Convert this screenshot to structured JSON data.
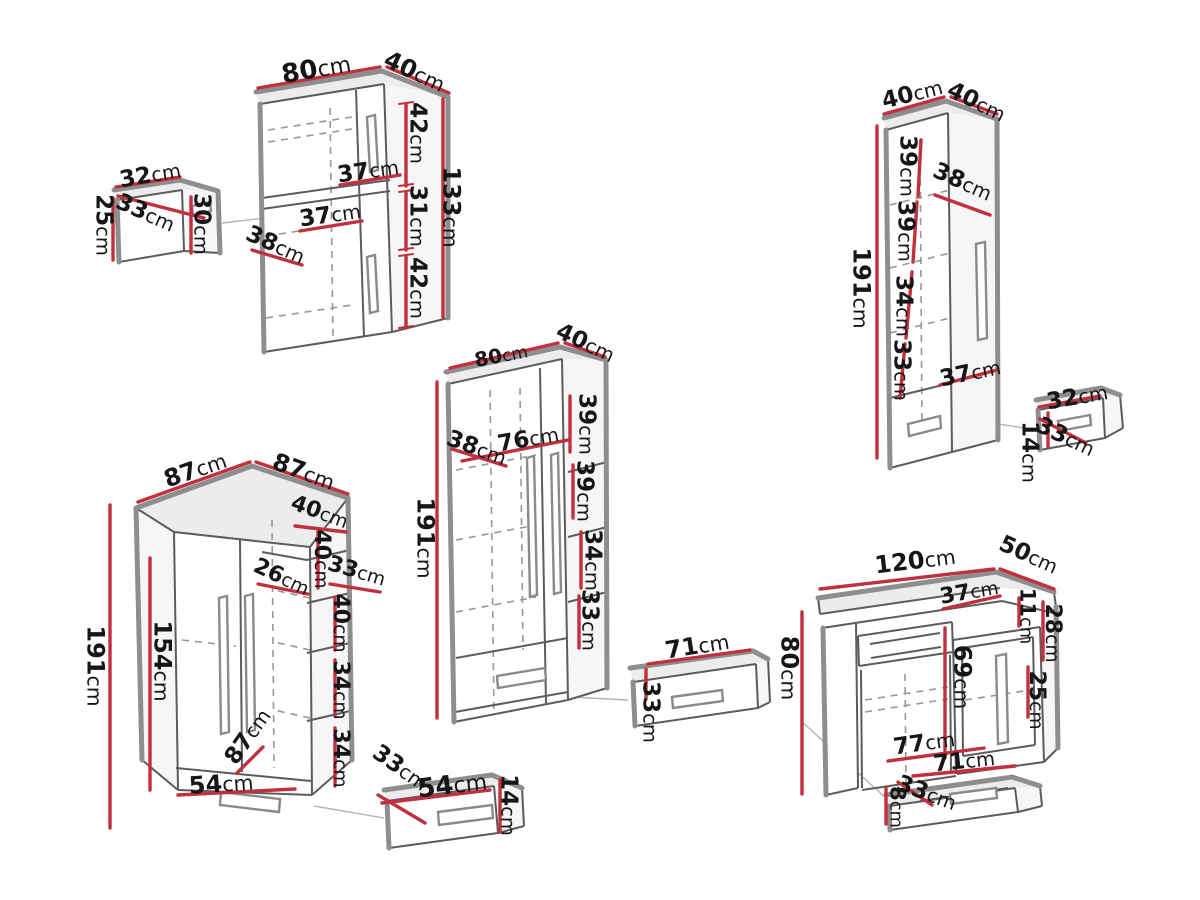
{
  "unit": "cm",
  "colors": {
    "dimension_line": "#c0303e",
    "edge_thick": "#8e8e8e",
    "edge_thin": "#5c5c5c",
    "text": "#161616",
    "background": "#ffffff"
  },
  "pieces": [
    {
      "name": "wall-cabinet",
      "dims": [
        {
          "v": "80",
          "x": 316,
          "y": 68,
          "r": -10,
          "s": 26
        },
        {
          "v": "40",
          "x": 415,
          "y": 71,
          "r": 25,
          "s": 24
        },
        {
          "v": "42",
          "x": 419,
          "y": 133,
          "r": 90,
          "s": 23
        },
        {
          "v": "37",
          "x": 368,
          "y": 170,
          "r": -8,
          "s": 23
        },
        {
          "v": "31",
          "x": 419,
          "y": 216,
          "r": 90,
          "s": 23
        },
        {
          "v": "37",
          "x": 330,
          "y": 214,
          "r": -8,
          "s": 23
        },
        {
          "v": "38",
          "x": 276,
          "y": 244,
          "r": 24,
          "s": 23
        },
        {
          "v": "42",
          "x": 419,
          "y": 288,
          "r": 90,
          "s": 23
        },
        {
          "v": "133",
          "x": 452,
          "y": 207,
          "r": 90,
          "s": 24
        }
      ]
    },
    {
      "name": "wall-box",
      "dims": [
        {
          "v": "32",
          "x": 150,
          "y": 174,
          "r": -10,
          "s": 23
        },
        {
          "v": "33",
          "x": 146,
          "y": 212,
          "r": 24,
          "s": 23
        },
        {
          "v": "25",
          "x": 105,
          "y": 225,
          "r": 90,
          "s": 23
        },
        {
          "v": "30",
          "x": 203,
          "y": 224,
          "r": 90,
          "s": 23
        }
      ]
    },
    {
      "name": "tall-cabinet",
      "dims": [
        {
          "v": "40",
          "x": 912,
          "y": 93,
          "r": -14,
          "s": 23
        },
        {
          "v": "40",
          "x": 977,
          "y": 101,
          "r": 26,
          "s": 23
        },
        {
          "v": "38",
          "x": 963,
          "y": 181,
          "r": 24,
          "s": 23
        },
        {
          "v": "39",
          "x": 909,
          "y": 166,
          "r": 90,
          "s": 23
        },
        {
          "v": "39",
          "x": 907,
          "y": 231,
          "r": 90,
          "s": 23
        },
        {
          "v": "34",
          "x": 905,
          "y": 306,
          "r": 90,
          "s": 23
        },
        {
          "v": "33",
          "x": 903,
          "y": 370,
          "r": 90,
          "s": 23
        },
        {
          "v": "37",
          "x": 970,
          "y": 372,
          "r": -12,
          "s": 23
        },
        {
          "v": "191",
          "x": 862,
          "y": 288,
          "r": 90,
          "s": 24
        }
      ]
    },
    {
      "name": "hanging-drawer",
      "dims": [
        {
          "v": "32",
          "x": 1077,
          "y": 396,
          "r": -10,
          "s": 23
        },
        {
          "v": "33",
          "x": 1066,
          "y": 436,
          "r": 25,
          "s": 23
        },
        {
          "v": "14",
          "x": 1031,
          "y": 452,
          "r": 90,
          "s": 23
        }
      ]
    },
    {
      "name": "wardrobe",
      "dims": [
        {
          "v": "80",
          "x": 501,
          "y": 355,
          "r": -11,
          "s": 20
        },
        {
          "v": "40",
          "x": 586,
          "y": 342,
          "r": 25,
          "s": 23
        },
        {
          "v": "39",
          "x": 588,
          "y": 424,
          "r": 90,
          "s": 23
        },
        {
          "v": "38",
          "x": 477,
          "y": 447,
          "r": 20,
          "s": 23
        },
        {
          "v": "76",
          "x": 528,
          "y": 438,
          "r": -10,
          "s": 23
        },
        {
          "v": "39",
          "x": 586,
          "y": 491,
          "r": 90,
          "s": 23
        },
        {
          "v": "34",
          "x": 594,
          "y": 560,
          "r": 90,
          "s": 23
        },
        {
          "v": "33",
          "x": 591,
          "y": 620,
          "r": 90,
          "s": 23
        },
        {
          "v": "191",
          "x": 426,
          "y": 538,
          "r": 90,
          "s": 24
        }
      ]
    },
    {
      "name": "drawer",
      "dims": [
        {
          "v": "71",
          "x": 697,
          "y": 645,
          "r": -9,
          "s": 24
        },
        {
          "v": "33",
          "x": 652,
          "y": 712,
          "r": 90,
          "s": 23
        }
      ]
    },
    {
      "name": "corner-wardrobe",
      "dims": [
        {
          "v": "87",
          "x": 195,
          "y": 469,
          "r": -19,
          "s": 24
        },
        {
          "v": "87",
          "x": 304,
          "y": 471,
          "r": 20,
          "s": 24
        },
        {
          "v": "40",
          "x": 320,
          "y": 511,
          "r": 20,
          "s": 22
        },
        {
          "v": "40",
          "x": 323,
          "y": 559,
          "r": 90,
          "s": 22
        },
        {
          "v": "26",
          "x": 282,
          "y": 576,
          "r": 25,
          "s": 22
        },
        {
          "v": "33",
          "x": 357,
          "y": 570,
          "r": 16,
          "s": 22
        },
        {
          "v": "40",
          "x": 342,
          "y": 623,
          "r": 90,
          "s": 22
        },
        {
          "v": "34",
          "x": 342,
          "y": 690,
          "r": 90,
          "s": 22
        },
        {
          "v": "34",
          "x": 342,
          "y": 758,
          "r": 90,
          "s": 22
        },
        {
          "v": "191",
          "x": 96,
          "y": 666,
          "r": 90,
          "s": 24
        },
        {
          "v": "154",
          "x": 163,
          "y": 661,
          "r": 90,
          "s": 24
        },
        {
          "v": "87",
          "x": 247,
          "y": 736,
          "r": -55,
          "s": 23
        },
        {
          "v": "54",
          "x": 221,
          "y": 783,
          "r": -4,
          "s": 24
        }
      ]
    },
    {
      "name": "underbed-drawer",
      "dims": [
        {
          "v": "33",
          "x": 401,
          "y": 767,
          "r": 35,
          "s": 23
        },
        {
          "v": "54",
          "x": 452,
          "y": 784,
          "r": -7,
          "s": 26
        },
        {
          "v": "14",
          "x": 510,
          "y": 805,
          "r": 90,
          "s": 23
        }
      ]
    },
    {
      "name": "desk",
      "dims": [
        {
          "v": "120",
          "x": 915,
          "y": 560,
          "r": -7,
          "s": 24
        },
        {
          "v": "50",
          "x": 1029,
          "y": 554,
          "r": 24,
          "s": 23
        },
        {
          "v": "37",
          "x": 969,
          "y": 591,
          "r": -10,
          "s": 22
        },
        {
          "v": "11",
          "x": 1028,
          "y": 616,
          "r": 90,
          "s": 21
        },
        {
          "v": "28",
          "x": 1054,
          "y": 633,
          "r": 90,
          "s": 22
        },
        {
          "v": "80",
          "x": 790,
          "y": 668,
          "r": 90,
          "s": 24
        },
        {
          "v": "69",
          "x": 963,
          "y": 677,
          "r": 90,
          "s": 24
        },
        {
          "v": "25",
          "x": 1038,
          "y": 700,
          "r": 90,
          "s": 22
        },
        {
          "v": "77",
          "x": 924,
          "y": 742,
          "r": -8,
          "s": 23
        }
      ]
    },
    {
      "name": "desk-drawer",
      "dims": [
        {
          "v": "71",
          "x": 964,
          "y": 760,
          "r": -6,
          "s": 23
        },
        {
          "v": "33",
          "x": 927,
          "y": 792,
          "r": 20,
          "s": 23
        },
        {
          "v": "8",
          "x": 898,
          "y": 807,
          "r": 90,
          "s": 21
        }
      ]
    }
  ]
}
